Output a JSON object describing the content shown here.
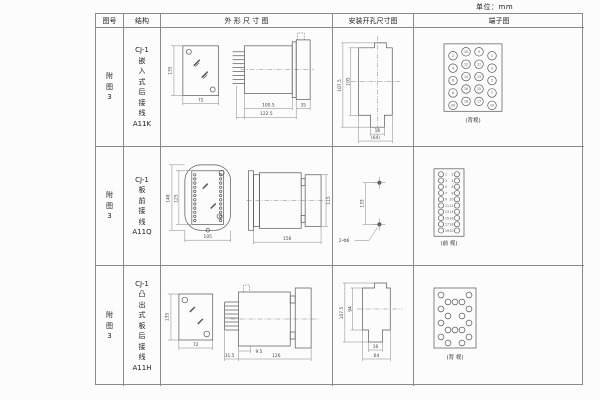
{
  "unit_label": "单位：mm",
  "columns": {
    "figure": "图号",
    "structure": "结构",
    "outline": "外 形 尺 寸 图",
    "mounting": "安装开孔尺寸图",
    "terminal": "端子图"
  },
  "rows": [
    {
      "figure_no": "附\n图\n3",
      "structure": "CJ-1\n嵌\n入\n式\n后\n接\n线\nA11K",
      "outline": {
        "front_height": "135",
        "front_width": "72",
        "body_depth": "100.5",
        "total_depth": "122.5",
        "rear_depth": "35"
      },
      "mounting": {
        "outer_height": "107.5",
        "inner_height": "105",
        "notch_width": "16",
        "opening_width": "(64)"
      },
      "terminal": {
        "view_label": "(背视)",
        "pin_cols": [
          [
            "2",
            "4",
            "6",
            "8",
            "20"
          ],
          [
            "10",
            "12",
            "14",
            "16",
            "18"
          ],
          [
            "9",
            "11",
            "13",
            "15",
            "17"
          ],
          [
            "1",
            "3",
            "5",
            "7",
            "19"
          ]
        ]
      }
    },
    {
      "figure_no": "附\n图\n3",
      "structure": "CJ-1\n板\n前\n接\n线\nA11Q",
      "outline": {
        "front_height": "148",
        "window_height": "125",
        "front_width": "105",
        "total_depth": "156",
        "rear_height": "115"
      },
      "mounting": {
        "hole_spacing": "133",
        "hole_label": "2-Φ6"
      },
      "terminal": {
        "view_label": "(前 视)",
        "left_pins": [
          "1",
          "3",
          "5",
          "7",
          "9",
          "11",
          "13",
          "15",
          "17",
          "19"
        ],
        "right_pins": [
          "2",
          "4",
          "6",
          "8",
          "10",
          "12",
          "14",
          "16",
          "18",
          "20"
        ]
      }
    },
    {
      "figure_no": "附\n图\n3",
      "structure": "CJ-1\n凸\n出\n式\n板\n后\n接\n线\nA11H",
      "outline": {
        "front_height": "135",
        "front_width": "72",
        "pin_depth": "31.5",
        "step_depth": "9.5",
        "total_depth": "126"
      },
      "mounting": {
        "outer_height": "107.5",
        "inner_height": "94",
        "notch_width": "16",
        "opening_width": "64"
      },
      "terminal": {
        "view_label": "(背 视)"
      }
    }
  ]
}
